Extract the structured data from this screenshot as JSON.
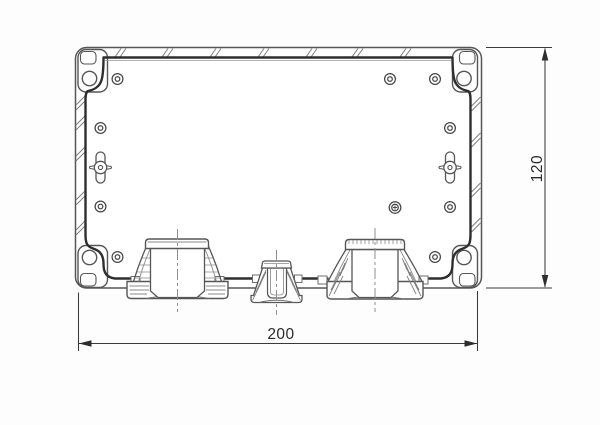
{
  "drawing": {
    "type": "technical-drawing",
    "subject": "plastic enclosure, internal section view with cable glands",
    "dimensions": {
      "width_label": "200",
      "height_label": "120"
    },
    "colors": {
      "background": "#fdfdfd",
      "outline": "#565656",
      "outline_dark": "#2e2e2e",
      "detail": "#6e6e6e",
      "hatch": "#7e7e7e",
      "centerline": "#8f8f8f",
      "dimension_line": "#3a3a3a",
      "text": "#2b2b2b"
    },
    "features": {
      "corner_screw_holes": 4,
      "screw_bosses": 9,
      "marked_boss": 1,
      "mounting_slots": 2,
      "cable_glands": [
        "left-large",
        "center-small",
        "right-large"
      ]
    }
  }
}
